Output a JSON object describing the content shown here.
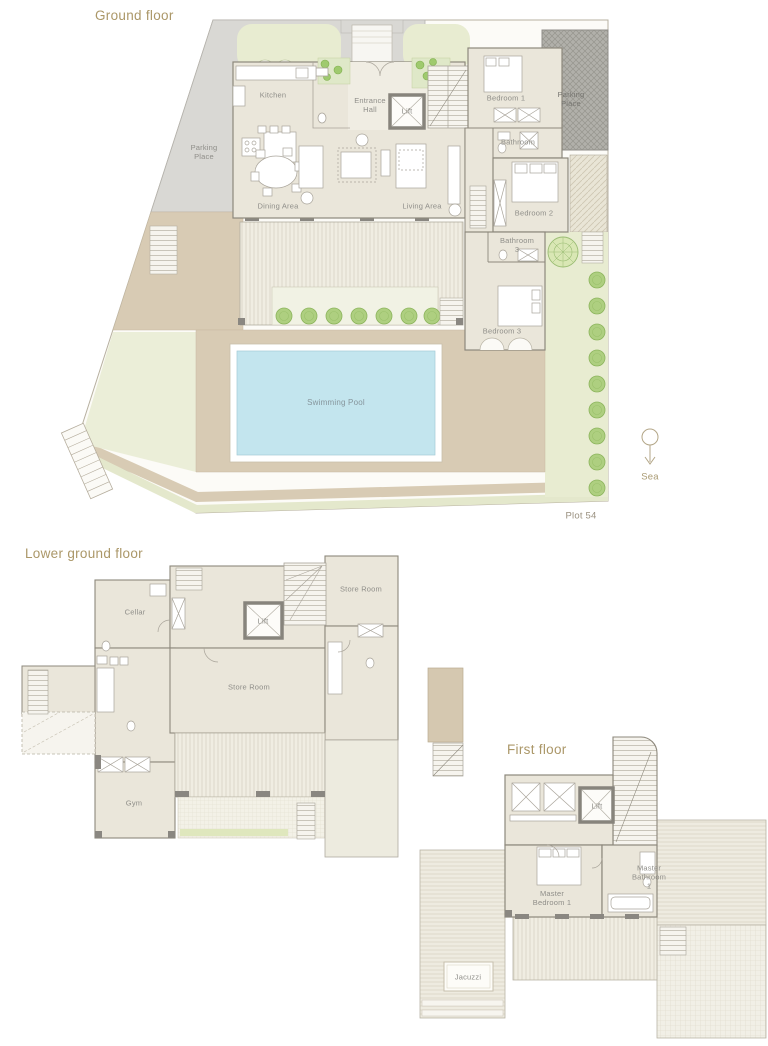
{
  "meta": {
    "document_type": "villa floor plans",
    "width_px": 768,
    "height_px": 1046
  },
  "palette": {
    "background": "#ffffff",
    "title_text": "#ab9768",
    "room_label_text": "#8f8e89",
    "pool_label_text": "#86959c",
    "plot_label_text": "#9a9180",
    "wall_line": "#8d887c",
    "room_fill": "#eae6da",
    "hall_fill": "#f0ede3",
    "terrace_fill": "#d8cbb4",
    "deck_fill": "#f0ede2",
    "garden_fill": "#e8ecd1",
    "bush_fill": "#aecf80",
    "open_parking_fill": "#d9d8d4",
    "covered_parking_fill": "#b1b0aa",
    "pool_fill": "#c3e5ee",
    "lift_border": "#87847c"
  },
  "sections": {
    "ground": {
      "title": "Ground floor",
      "labels": {
        "kitchen": "Kitchen",
        "entrance_hall": "Entrance Hall",
        "lift": "Lift",
        "bedroom_1": "Bedroom 1",
        "parking_place_right": "Parking Place",
        "bathroom": "Bathroom",
        "bedroom_2": "Bedroom 2",
        "bathroom_3": "Bathroom 3",
        "bedroom_3": "Bedroom 3",
        "dining_area": "Dining Area",
        "living_area": "Living Area",
        "parking_place_left": "Parking Place",
        "swimming_pool": "Swimming Pool",
        "sea": "Sea",
        "plot": "Plot 54"
      }
    },
    "lower": {
      "title": "Lower ground floor",
      "labels": {
        "cellar": "Cellar",
        "lift": "Lift",
        "store_room_upper": "Store Room",
        "store_room_main": "Store Room",
        "gym": "Gym"
      }
    },
    "first": {
      "title": "First floor",
      "labels": {
        "lift": "Lift",
        "master_bedroom_1": "Master Bedroom 1",
        "master_bathroom_1": "Master Bathroom 1",
        "jacuzzi": "Jacuzzi"
      }
    }
  }
}
